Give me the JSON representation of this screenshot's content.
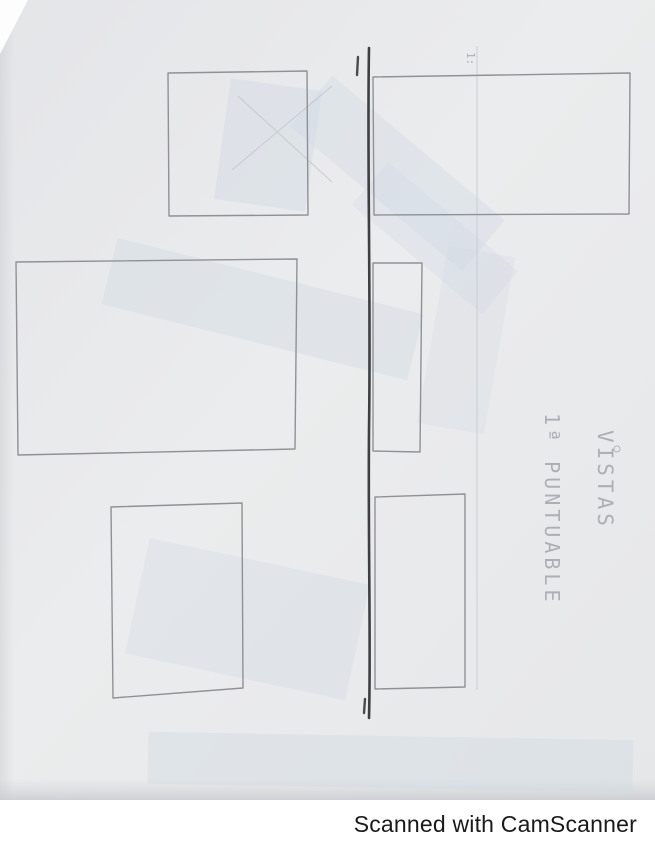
{
  "document": {
    "kind": "scanned pencil sketch on paper",
    "annotations": {
      "vistas_label": "VISTAS",
      "puntuable_label": "1ª PUNTUABLE",
      "corner_mark": "1:"
    },
    "drawing": {
      "rectangle_count": 6,
      "panels": [
        "top-left-square",
        "middle-left-rectangle",
        "bottom-left-rectangle",
        "top-right-rectangle",
        "middle-right-narrow-rectangle",
        "bottom-right-rectangle"
      ],
      "divider": "dark vertical ink line with end ticks"
    },
    "colors": {
      "paper": "#e9eaec",
      "pencil": "#8f9196",
      "dark_line": "#3e3f41",
      "bleed_blue": "#cfd9e4",
      "footer_text": "#1a1a1c"
    }
  },
  "footer": {
    "scanner_credit": "Scanned with CamScanner"
  }
}
